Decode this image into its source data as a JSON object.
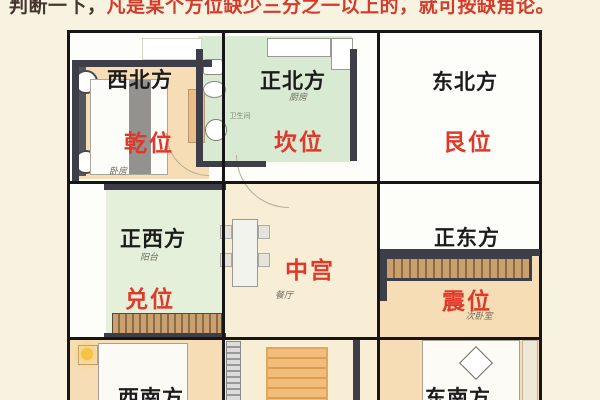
{
  "caption": {
    "prefix": "判断一下，",
    "main": "凡是某个方位缺少三分之一以上的，就可按缺角论。"
  },
  "cells": {
    "nw": {
      "direction": "西北方",
      "palace": "乾位",
      "room": "卧房"
    },
    "n": {
      "direction": "正北方",
      "palace": "坎位",
      "room": "厨房"
    },
    "ne": {
      "direction": "东北方",
      "palace": "艮位"
    },
    "w": {
      "direction": "正西方",
      "palace": "兑位",
      "room": "阳台"
    },
    "c": {
      "palace": "中宫",
      "room": "餐厅"
    },
    "e": {
      "direction": "正东方",
      "palace": "震位",
      "room": "次卧室"
    },
    "sw": {
      "direction": "西南方"
    },
    "se": {
      "direction": "东南方"
    },
    "bathroom": {
      "room": "卫生间"
    }
  },
  "colors": {
    "bg": "#f8f2e0",
    "caption_dark": "#44362e",
    "caption_red": "#d43a2a",
    "direction": "#1c1c1c",
    "palace": "#e0392a",
    "grid": "#161616",
    "wall": "#3e3e48",
    "peach": "#f7ddb5",
    "green": "#d9ead3",
    "balcony_green": "#e4f0d9",
    "cream": "#f8eed6"
  }
}
